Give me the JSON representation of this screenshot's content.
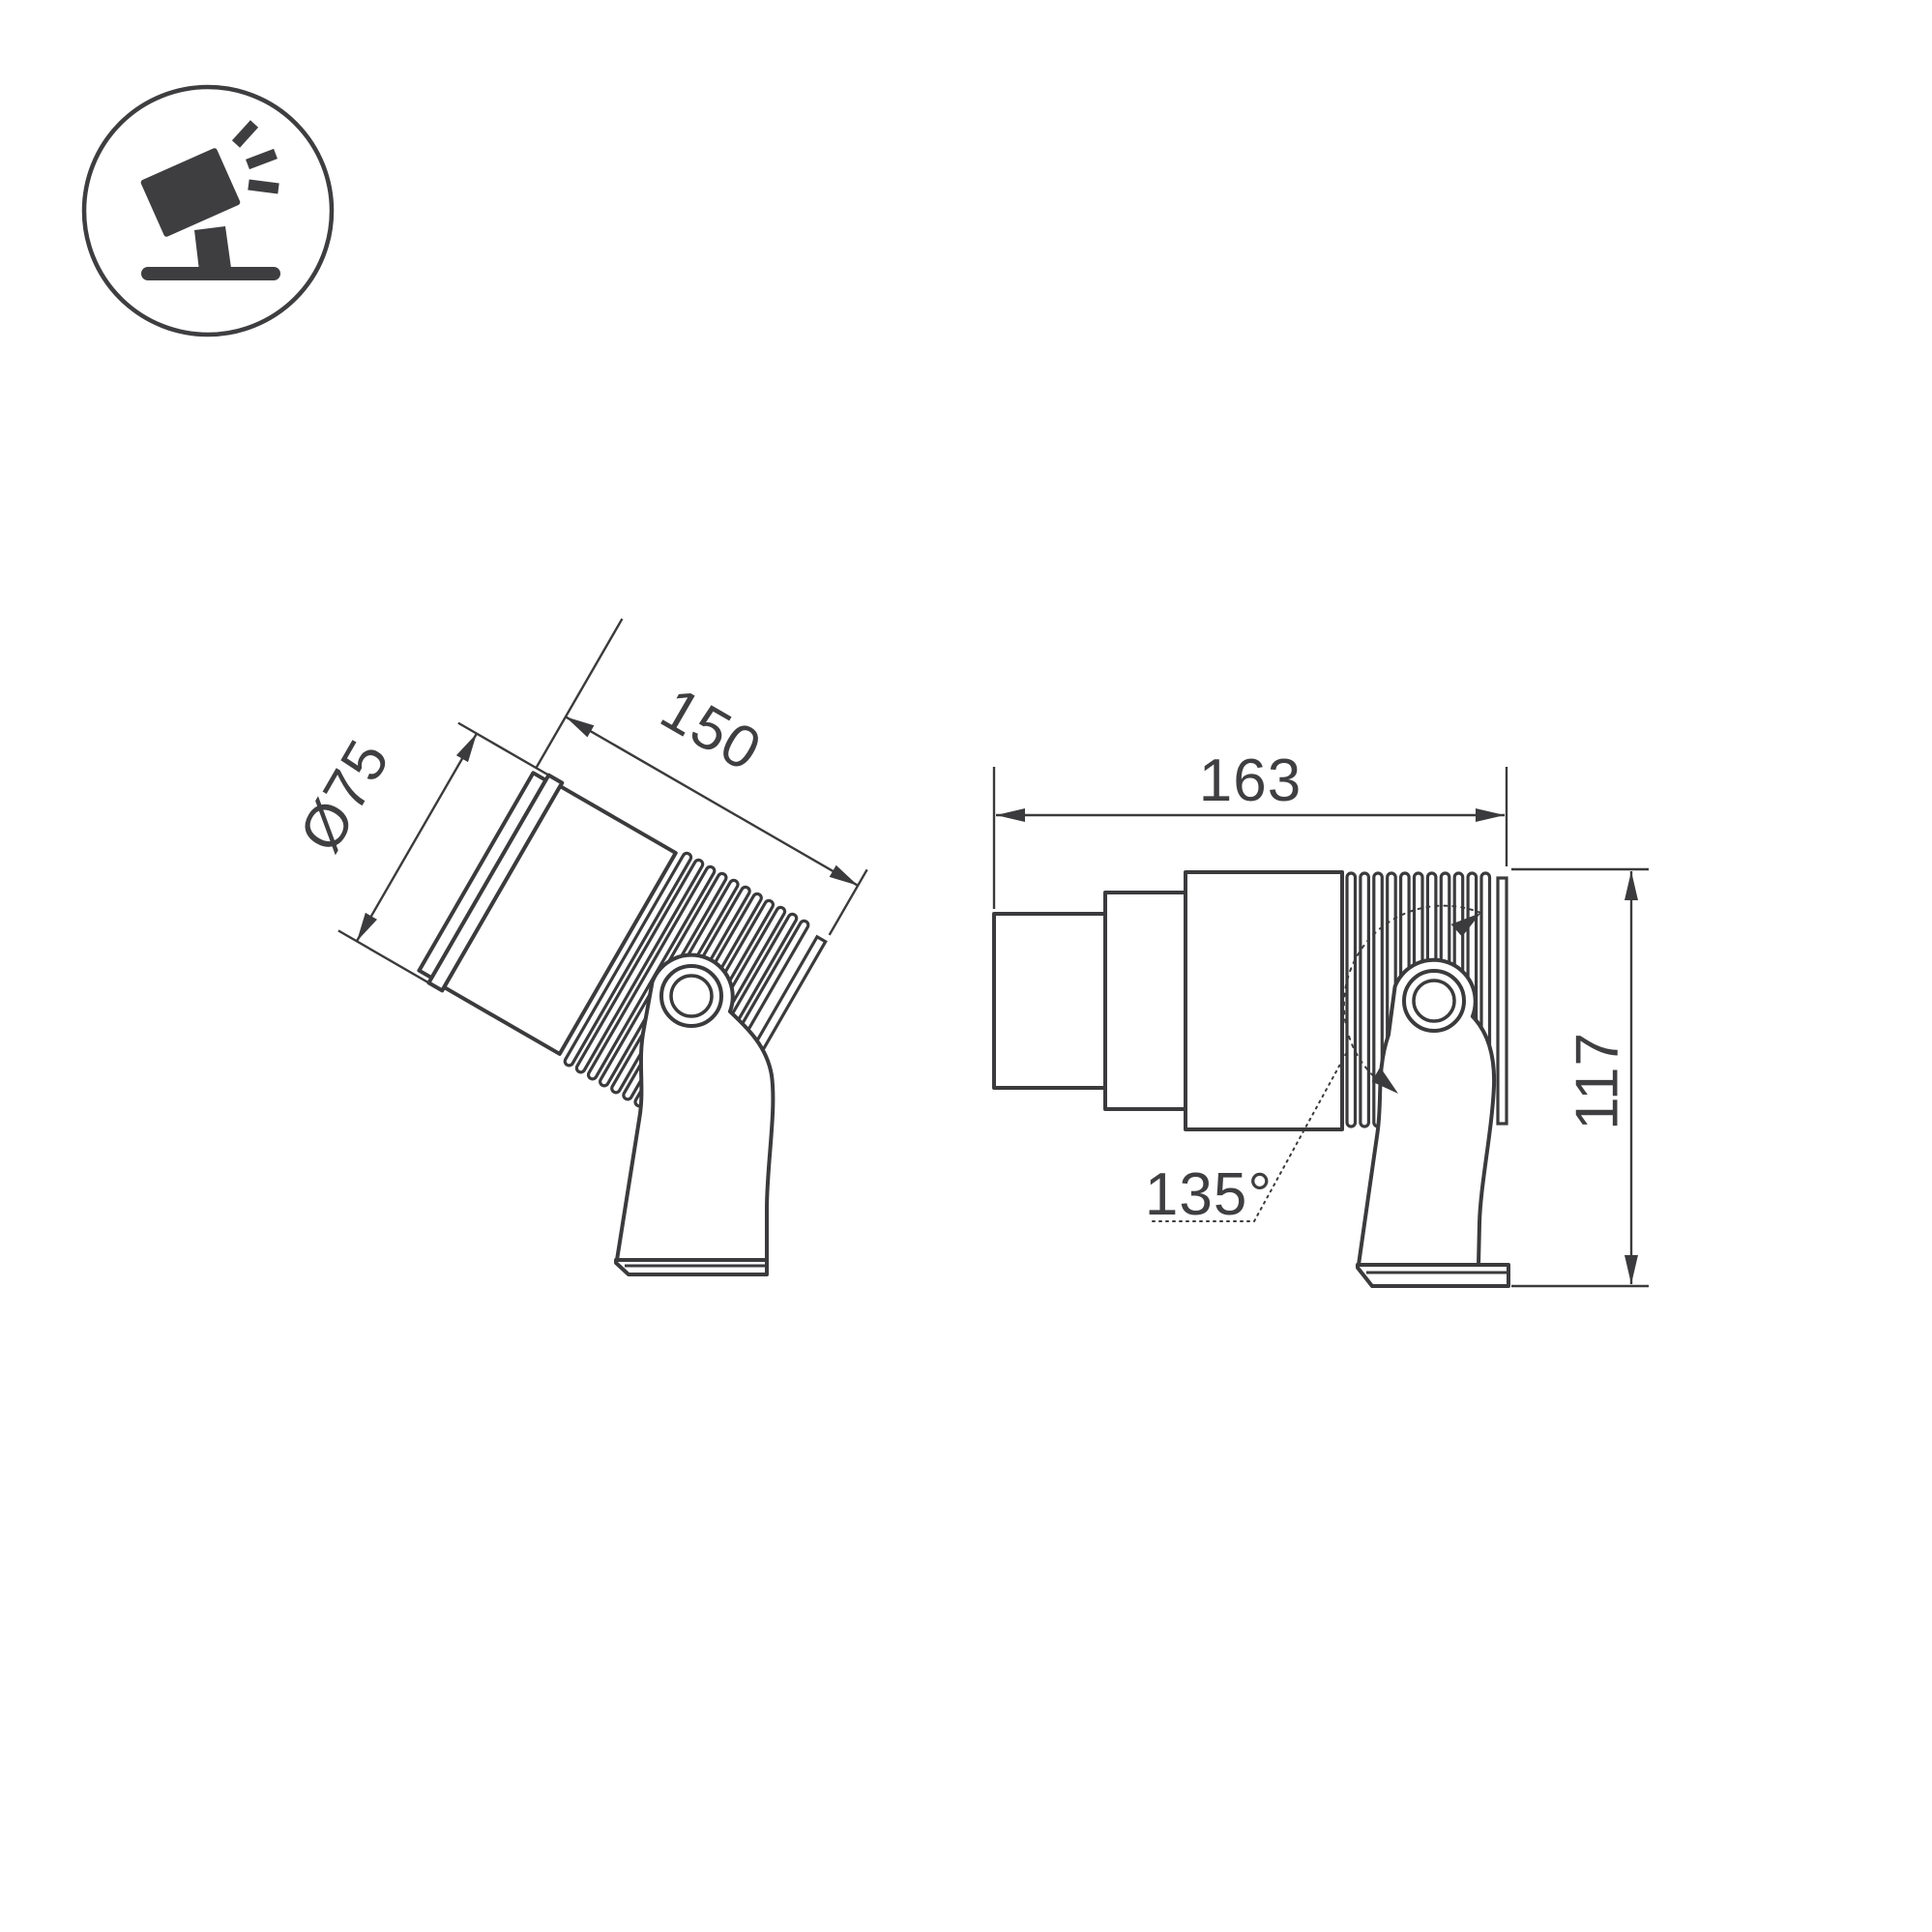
{
  "page": {
    "background": "#ffffff"
  },
  "icon": {
    "label": "adjustable-spotlight-pictogram"
  },
  "drawing": {
    "left_view": {
      "diameter_label": "Ø75",
      "length_label": "150"
    },
    "right_view": {
      "length_label": "163",
      "height_label": "117",
      "angle_label": "135°"
    }
  },
  "colors": {
    "line": "#3b3b3d",
    "text": "#3f3f41"
  }
}
